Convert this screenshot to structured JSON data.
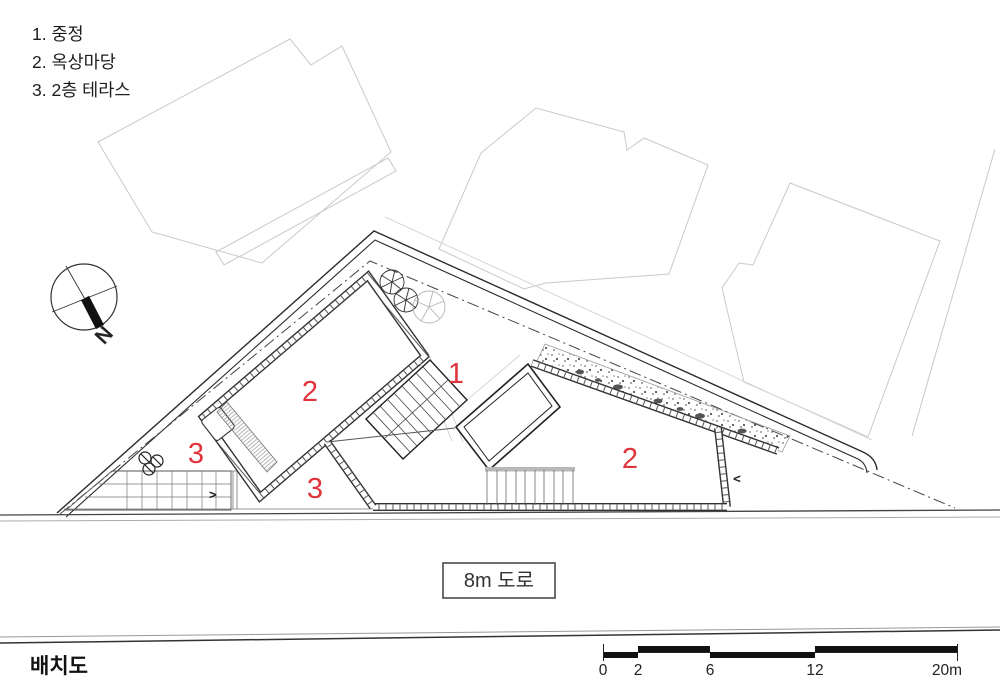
{
  "legend": {
    "items": [
      {
        "label": "1. 중정"
      },
      {
        "label": "2. 옥상마당"
      },
      {
        "label": "3. 2층 테라스"
      }
    ]
  },
  "compass": {
    "label": "N"
  },
  "plan_labels": [
    {
      "id": "area-1-courtyard",
      "text": "1"
    },
    {
      "id": "area-2-roofyard-left",
      "text": "2"
    },
    {
      "id": "area-3-terrace-left",
      "text": "3"
    },
    {
      "id": "area-3-terrace-center",
      "text": "3"
    },
    {
      "id": "area-2-roofyard-right",
      "text": "2"
    }
  ],
  "arrows": {
    "right": ">",
    "left": "<"
  },
  "road_label": "8m 도로",
  "title": "배치도",
  "scale_bar": {
    "unit_labels": [
      "0",
      "2",
      "6",
      "12",
      "20m"
    ],
    "meters": [
      0,
      2,
      6,
      12,
      20
    ]
  },
  "colors": {
    "accent_red": "#e0353d",
    "line_dark": "#2b2b2b",
    "neighbor_gray": "#c9c9c9"
  }
}
